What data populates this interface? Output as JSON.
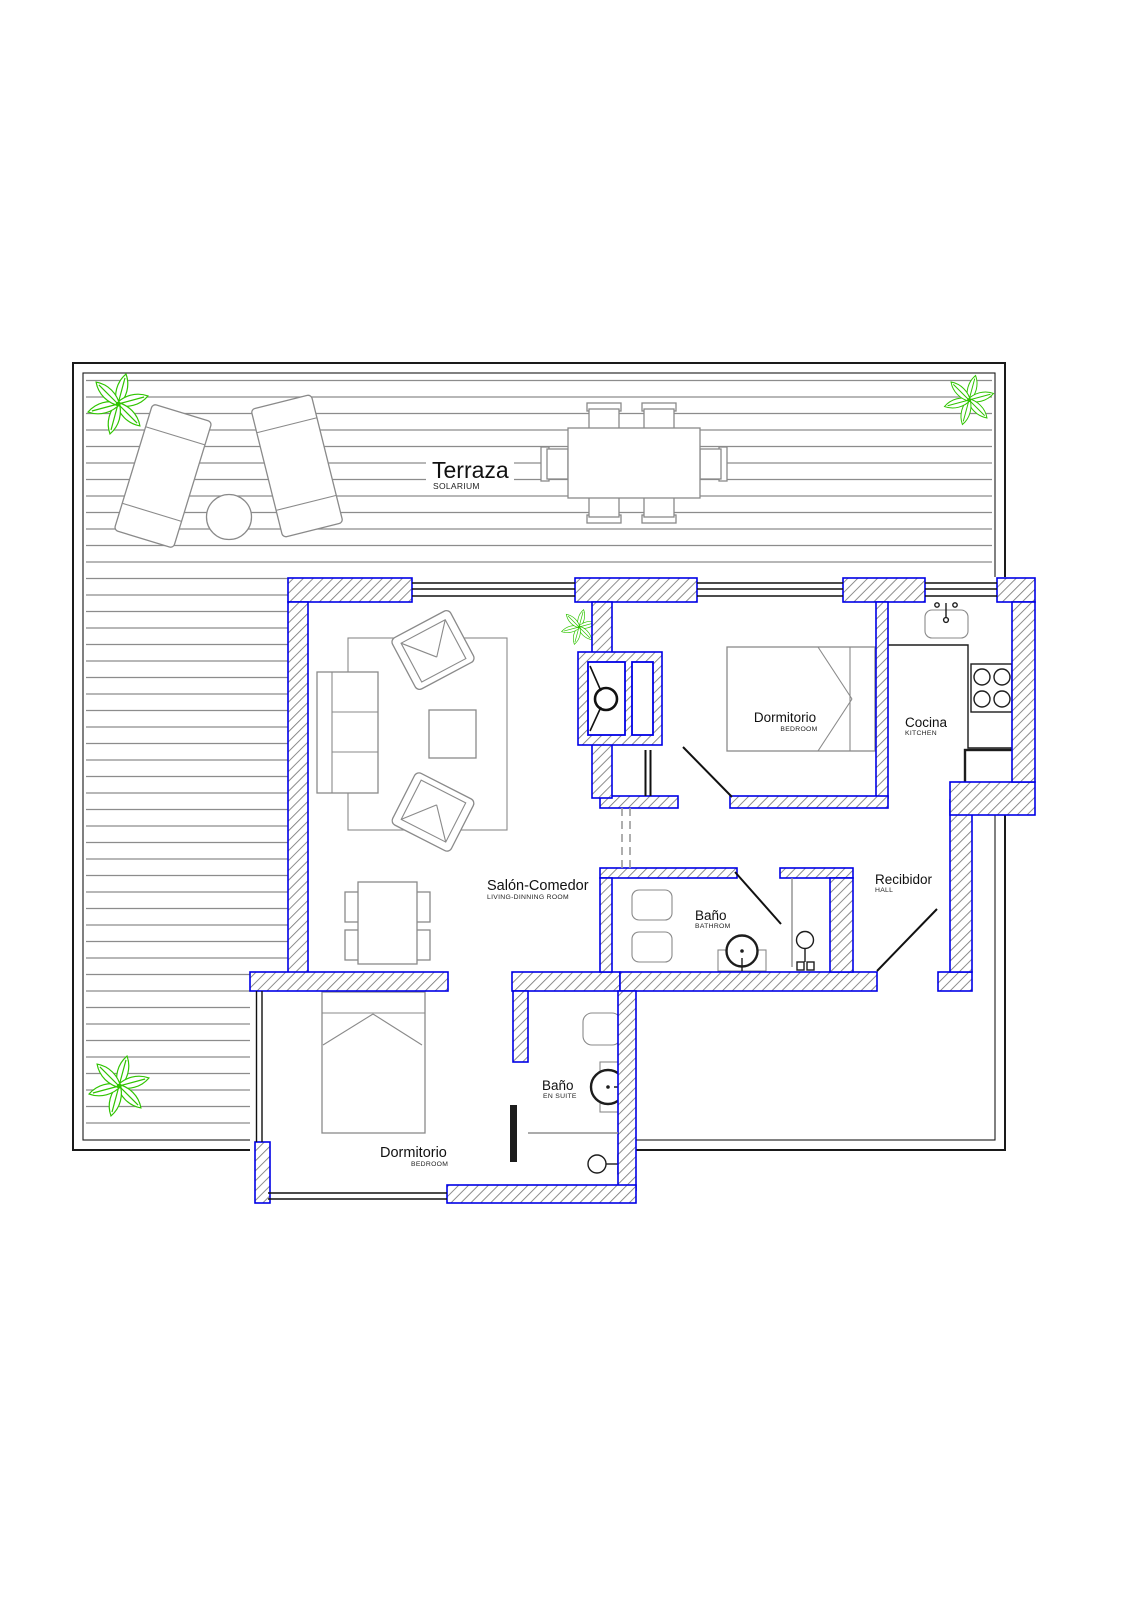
{
  "title": "Apartment floor plan",
  "labels": {
    "terraza": {
      "main": "Terraza",
      "sub": "SOLARIUM"
    },
    "salon": {
      "main": "Salón-Comedor",
      "sub": "LIVING-DINNING ROOM"
    },
    "dormitorio_1": {
      "main": "Dormitorio",
      "sub": "BEDROOM"
    },
    "cocina": {
      "main": "Cocina",
      "sub": "KITCHEN"
    },
    "bano": {
      "main": "Baño",
      "sub": "BATHROM"
    },
    "recibidor": {
      "main": "Recibidor",
      "sub": "HALL"
    },
    "bano_ensuite": {
      "main": "Baño",
      "sub": "EN SUITE"
    },
    "dormitorio_2": {
      "main": "Dormitorio",
      "sub": "BEDROOM"
    }
  },
  "colors": {
    "wall-blue": "#0000e6",
    "furn-grey": "#8a8a8a",
    "deck-grey": "#8c8c8c",
    "plant-green": "#2fc400",
    "line-black": "#1a1a1a"
  }
}
